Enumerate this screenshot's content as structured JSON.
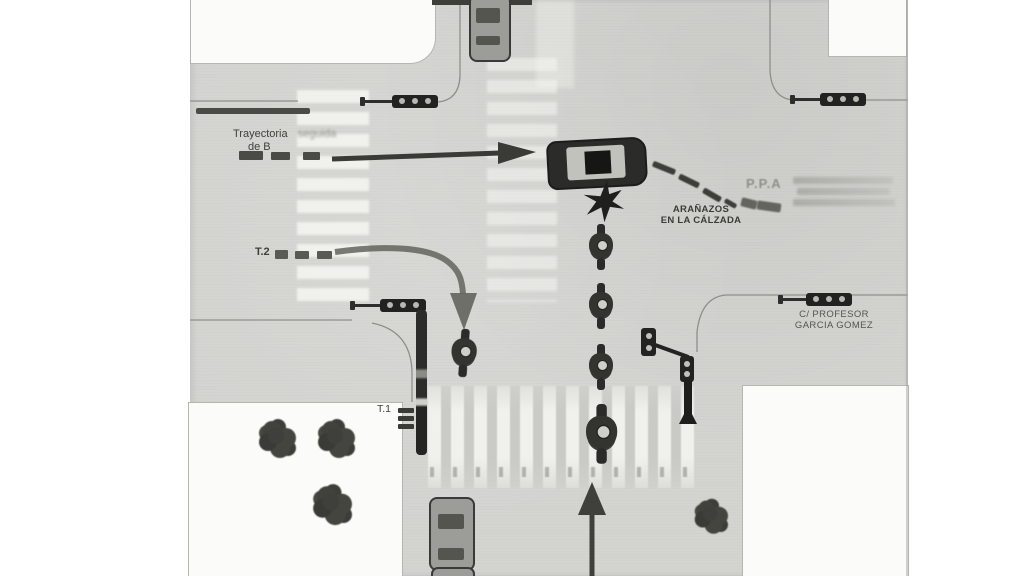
{
  "labels": {
    "trajectory_b": {
      "line1": "Trayectoria",
      "faint": "seguida",
      "line2": "de B"
    },
    "t2": "T.2",
    "t1": "T.1",
    "scratches": {
      "line1": "ARAÑAZOS",
      "line2": "EN LA CÁLZADA"
    },
    "ppa": "P.P.A",
    "street": {
      "line1": "C/ PROFESOR",
      "line2": "GARCIA GOMEZ"
    }
  },
  "colors": {
    "paper": "#ffffff",
    "road_gray": "#d3d3d0",
    "building_white": "#fbfbf9",
    "ink": "#3b3b37",
    "faded_ink": "#90908a"
  }
}
